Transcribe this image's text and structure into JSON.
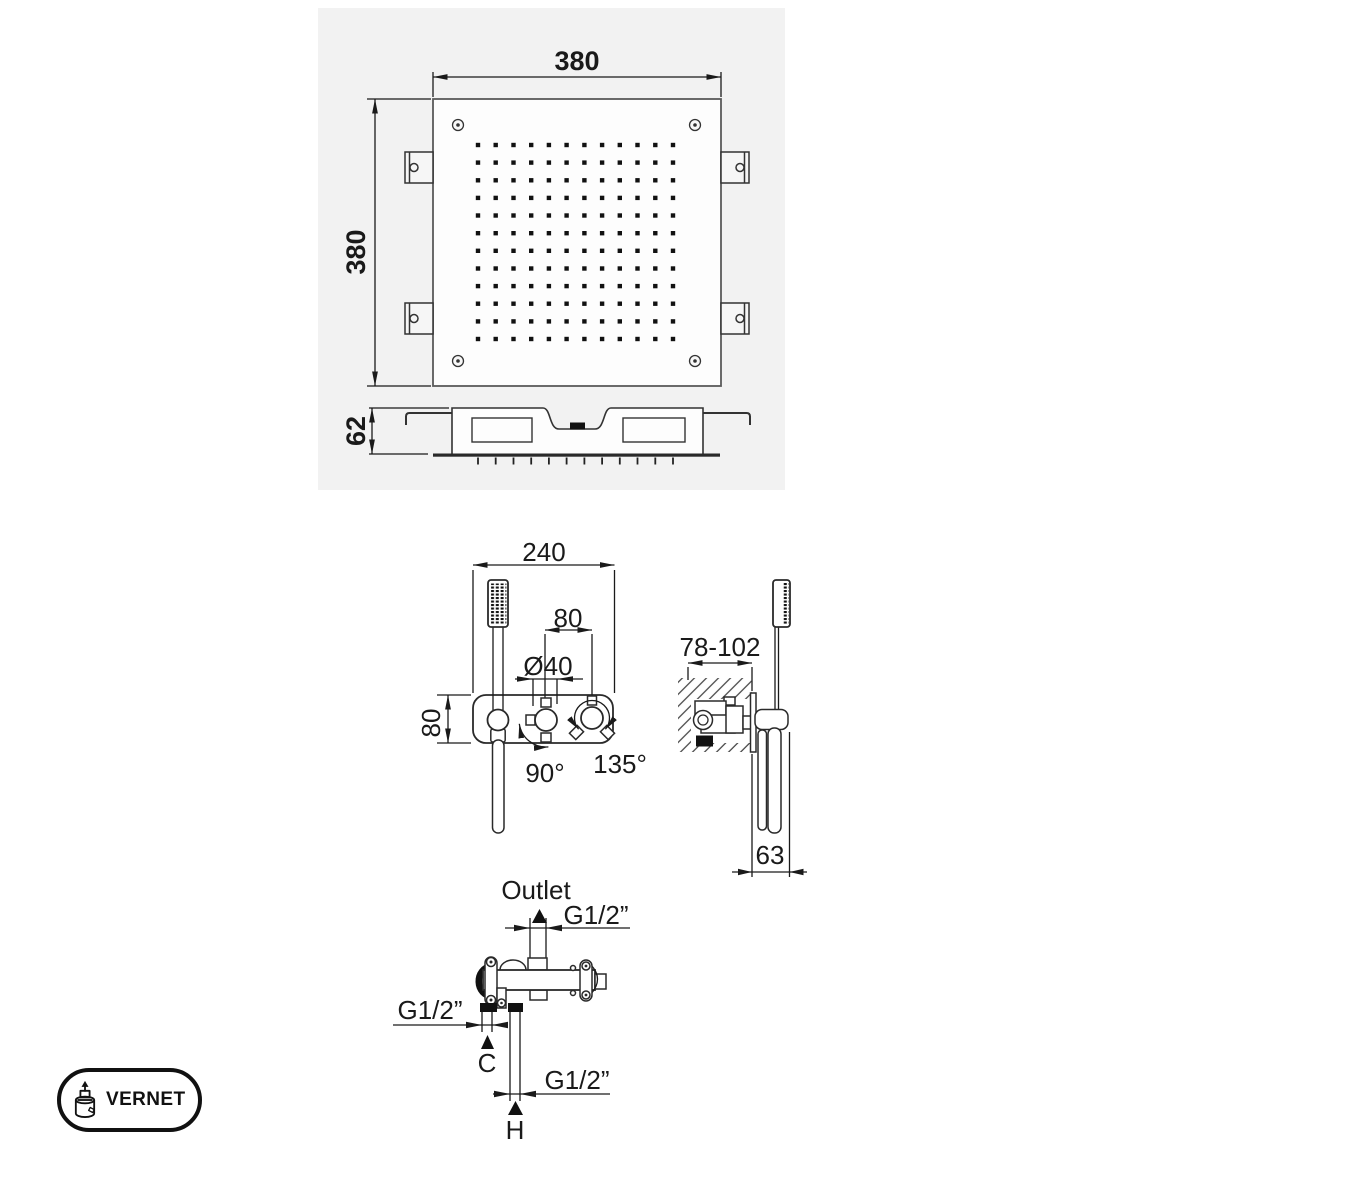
{
  "shower_head": {
    "plan": {
      "width": "380",
      "height": "380"
    },
    "profile": {
      "depth": "62"
    }
  },
  "mixer": {
    "front": {
      "width": "240",
      "centers": "80",
      "knob_diameter": "Ø40",
      "height": "80",
      "swing_left": "90°",
      "swing_right": "135°"
    },
    "side": {
      "recess_depth": "78-102",
      "handset_depth": "63"
    }
  },
  "valve": {
    "outlet_label": "Outlet",
    "outlet_thread": "G1/2”",
    "cold_thread": "G1/2”",
    "cold_mark": "C",
    "hot_thread": "G1/2”",
    "hot_mark": "H"
  },
  "logo": {
    "brand": "VERNET"
  },
  "colors": {
    "panel_bg": "#f2f2f2",
    "ink": "#1a1a1a"
  }
}
